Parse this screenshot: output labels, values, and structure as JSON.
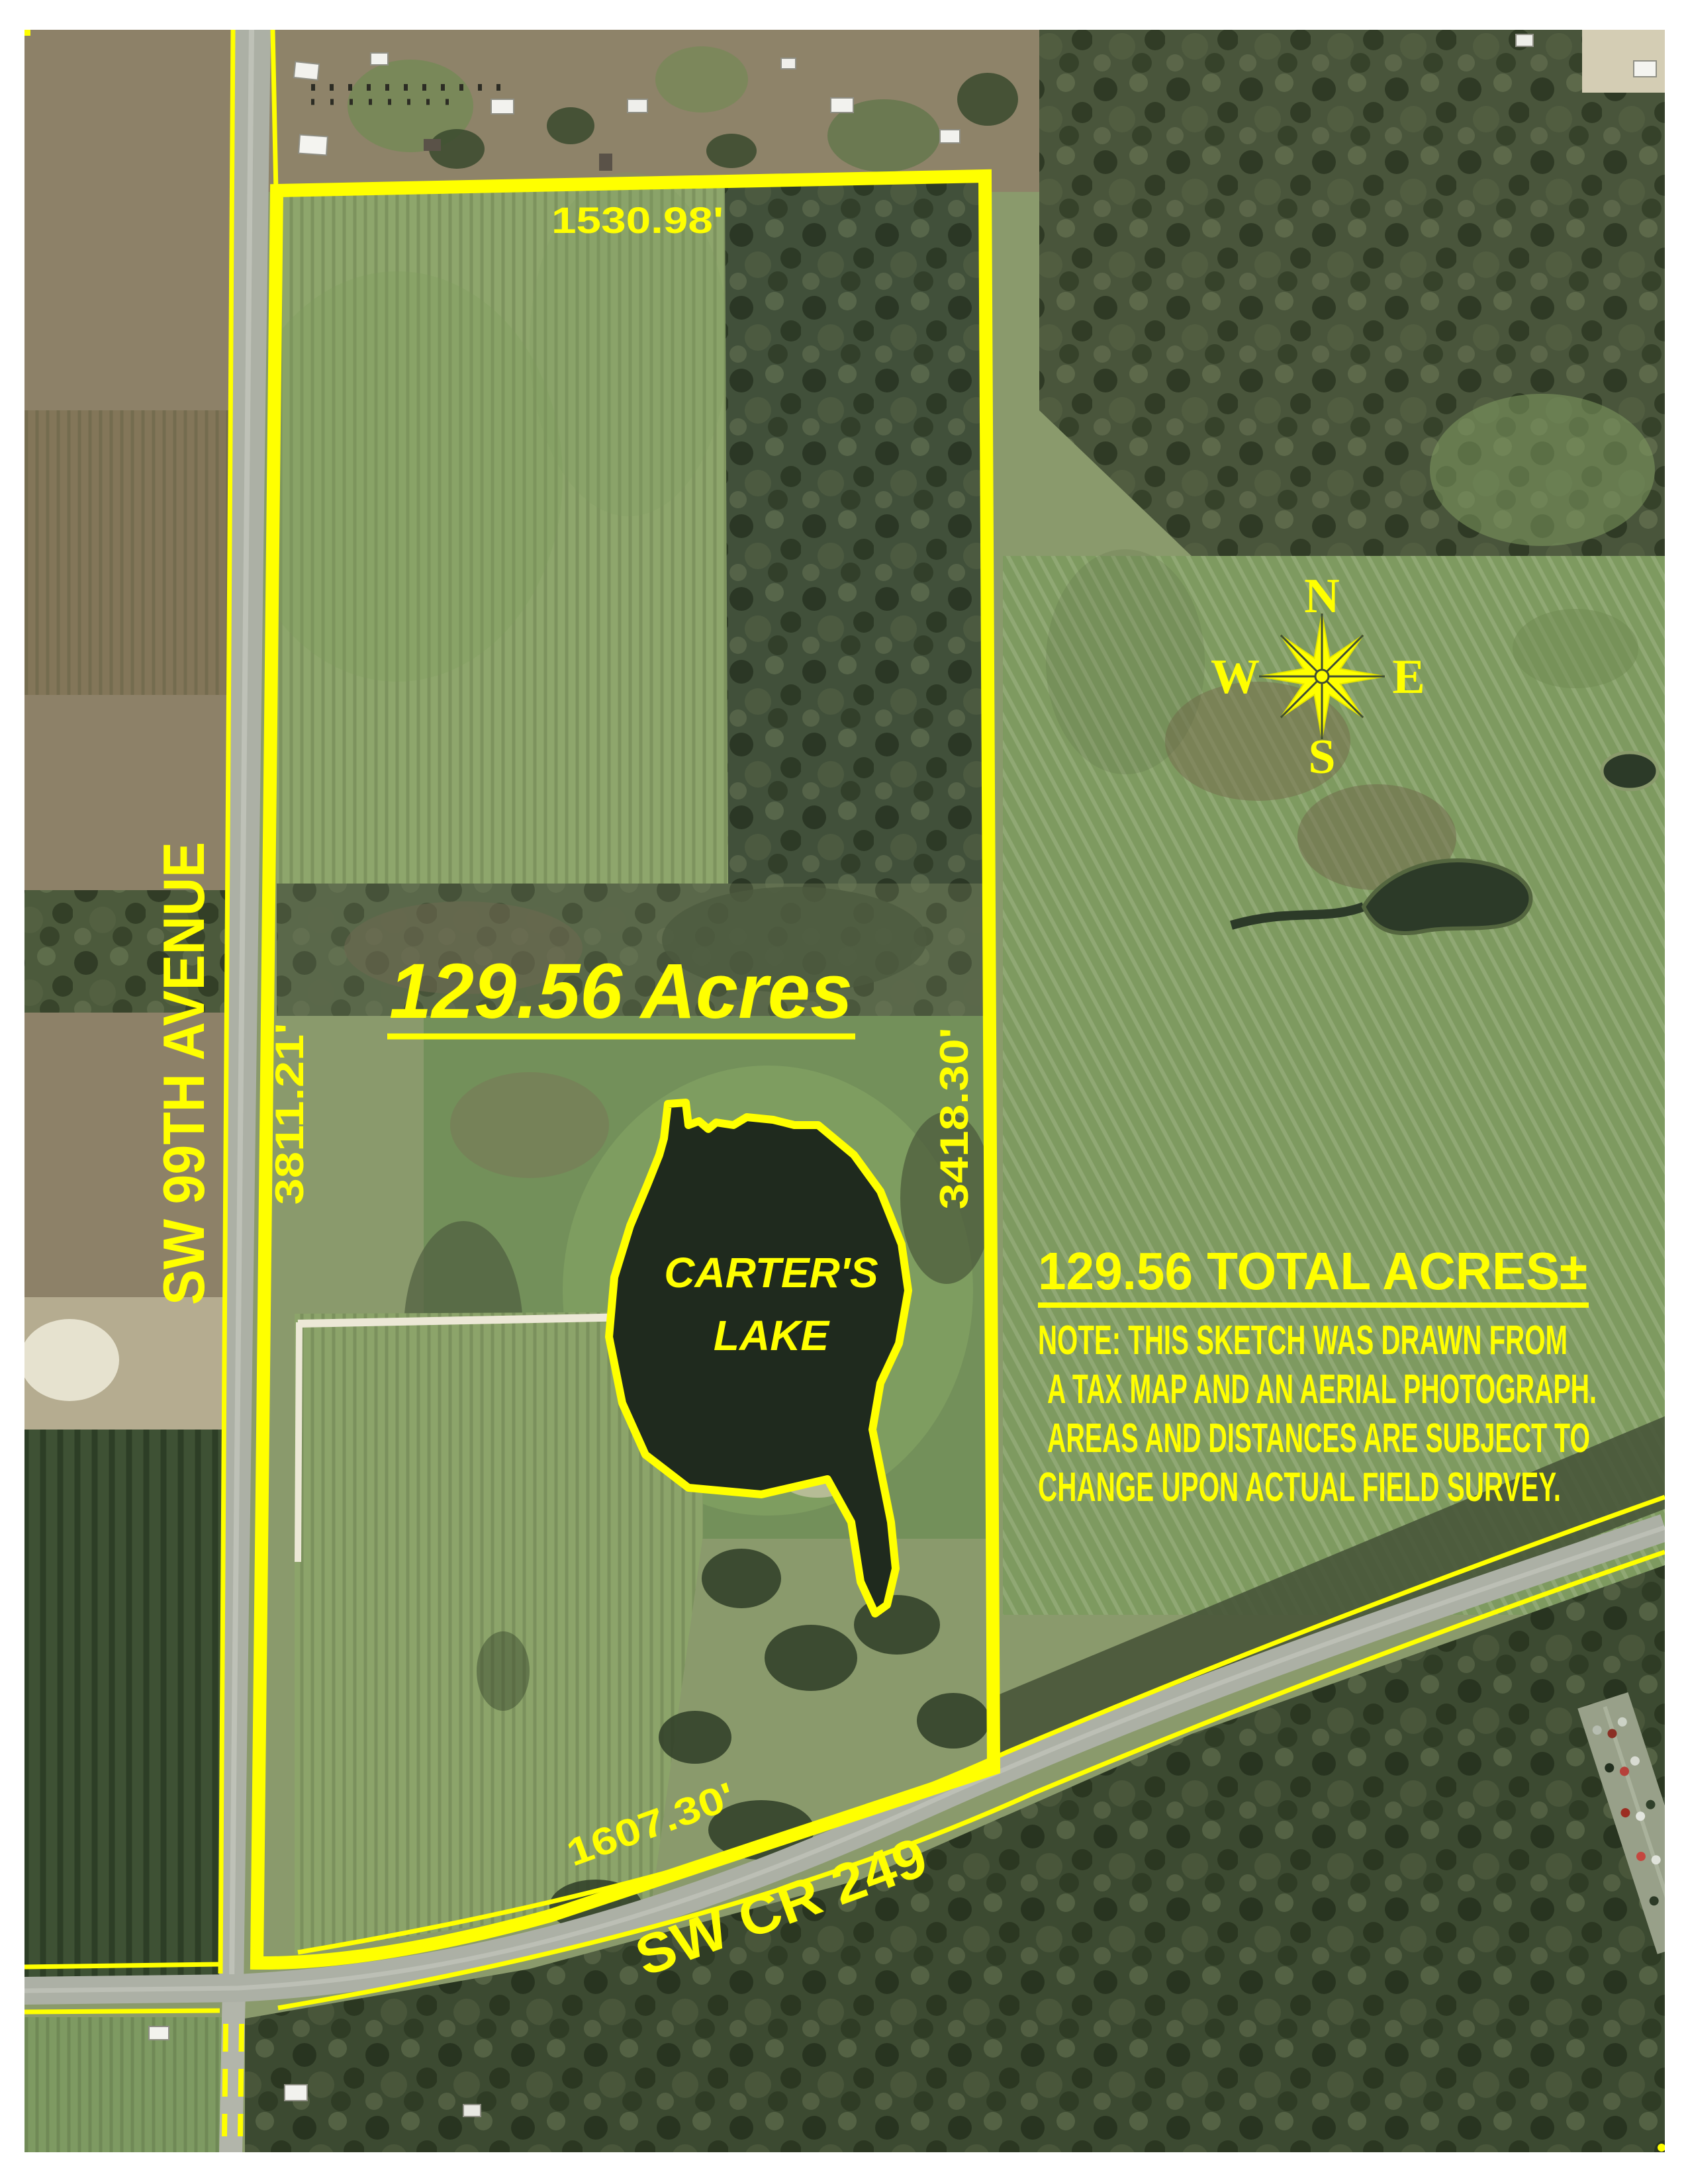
{
  "map": {
    "annotation_color": "#FFFF00",
    "dimensions": {
      "north": "1530.98'",
      "west": "3811.21'",
      "east": "3418.30'",
      "south": "1607.30'"
    },
    "streets": {
      "west": "SW 99TH AVENUE",
      "south": "SW CR 249"
    },
    "acreage": {
      "center": "129.56 Acres",
      "total": "129.56 TOTAL ACRES±"
    },
    "lake": {
      "line1": "CARTER'S",
      "line2": "LAKE"
    },
    "note": {
      "line1": "NOTE: THIS SKETCH WAS DRAWN FROM",
      "line2": "A TAX MAP AND AN AERIAL PHOTOGRAPH.",
      "line3": "AREAS AND DISTANCES ARE SUBJECT TO",
      "line4": "CHANGE UPON ACTUAL FIELD SURVEY."
    },
    "compass": {
      "n": "N",
      "s": "S",
      "e": "E",
      "w": "W"
    }
  }
}
